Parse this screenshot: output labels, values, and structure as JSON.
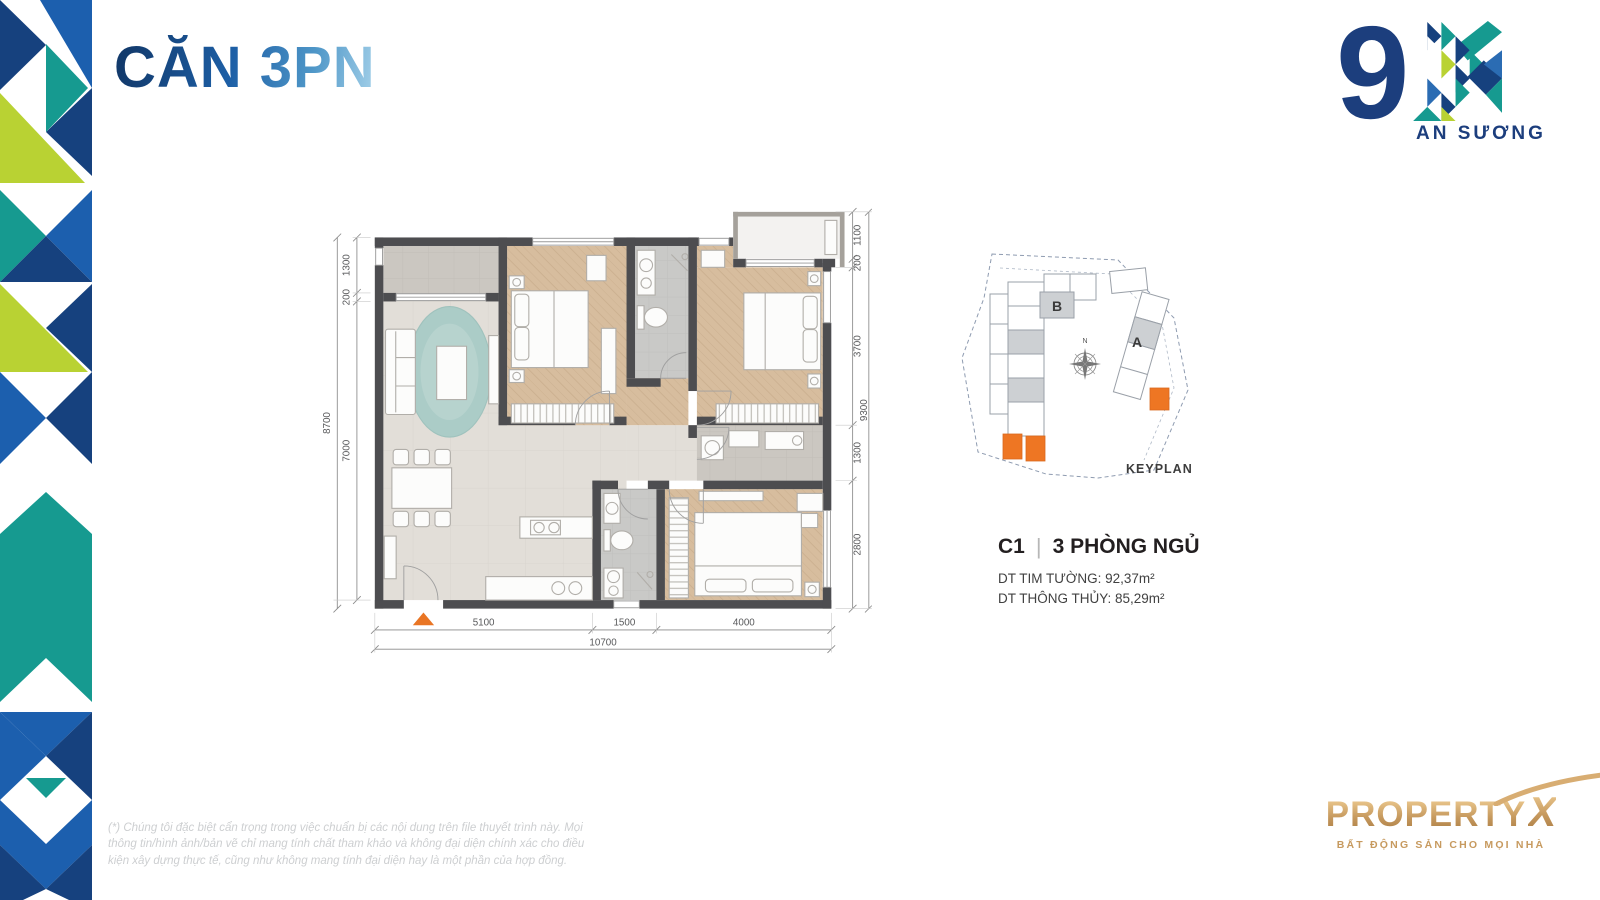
{
  "page": {
    "title": "CĂN 3PN"
  },
  "logo": {
    "nine": "9",
    "name": "AN SƯƠNG"
  },
  "plan": {
    "dims_left": [
      "1300",
      "200",
      "7000"
    ],
    "dims_left_total": "8700",
    "dims_right": [
      "1100",
      "200",
      "3700",
      "1300",
      "2800"
    ],
    "dims_right_total": "9300",
    "dims_bottom": [
      "5100",
      "1500",
      "4000"
    ],
    "dims_bottom_total": "10700"
  },
  "keyplan": {
    "title": "KEYPLAN",
    "block_a": "A",
    "block_b": "B",
    "north": "N"
  },
  "unit": {
    "code": "C1",
    "divider": "|",
    "type": "3 PHÒNG NGỦ",
    "area_wall": "DT TIM TƯỜNG: 92,37m²",
    "area_net": "DT THÔNG THỦY: 85,29m²"
  },
  "footer": {
    "disclaimer": "(*) Chúng tôi đặc biệt cẩn trọng trong việc chuẩn bị các nội dung trên file thuyết trình này. Mọi thông tin/hình ảnh/bản vẽ chỉ mang tính chất tham khảo và không đại diện chính xác cho điều kiện xây dựng thực tế, cũng như không mang tính đại diện hay là một phần của hợp đồng."
  },
  "brand": {
    "name": "PROPERTY",
    "x": "X",
    "tagline": "BẤT ĐỘNG SẢN CHO MỌI NHÀ"
  },
  "colors": {
    "navy": "#1c3e7d",
    "blue": "#2b6cb3",
    "teal": "#169a90",
    "lime": "#b9d233",
    "orange": "#e97524",
    "gold": "#c79a5f",
    "wall": "#4d4d50",
    "wood": "#d7bd9e"
  }
}
